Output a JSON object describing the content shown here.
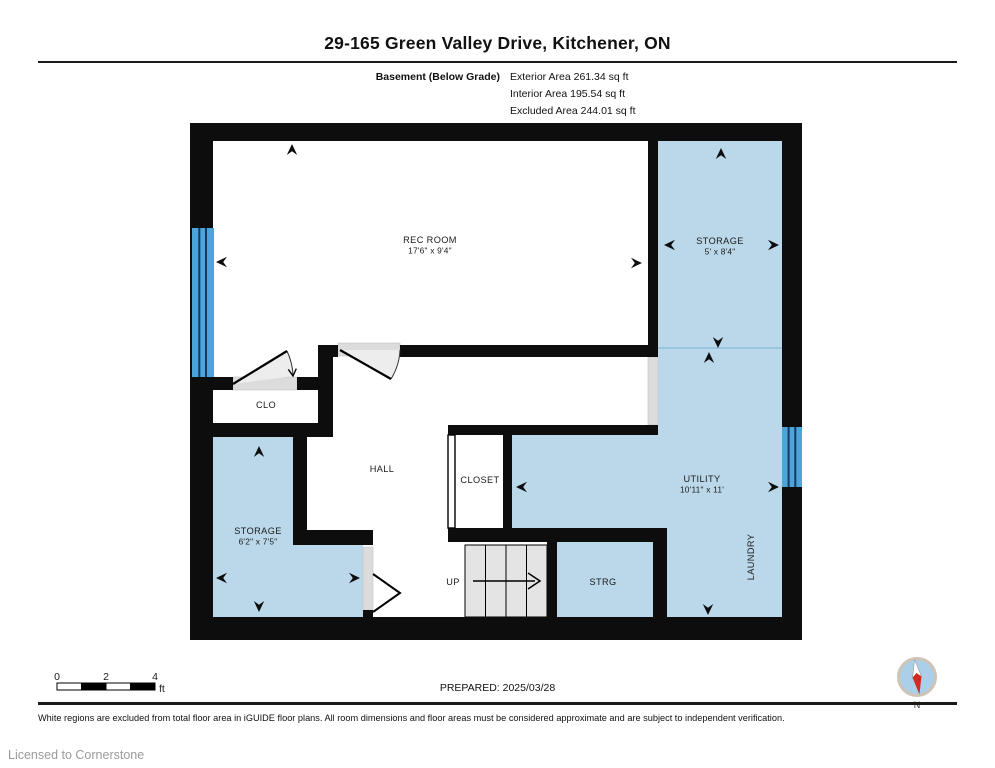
{
  "header": {
    "title": "29-165 Green Valley Drive, Kitchener, ON",
    "floor_label": "Basement (Below Grade)",
    "areas": [
      {
        "label": "Exterior Area 261.34 sq ft"
      },
      {
        "label": "Interior Area 195.54 sq ft"
      },
      {
        "label": "Excluded Area 244.01 sq ft"
      }
    ]
  },
  "plan": {
    "rooms": [
      {
        "name": "REC ROOM",
        "dims": "17'6\" x 9'4\""
      },
      {
        "name": "STORAGE",
        "dims": "5' x 8'4\""
      },
      {
        "name": "CLO",
        "dims": ""
      },
      {
        "name": "HALL",
        "dims": ""
      },
      {
        "name": "CLOSET",
        "dims": ""
      },
      {
        "name": "UTILITY",
        "dims": "10'11\" x 11'"
      },
      {
        "name": "LAUNDRY",
        "dims": ""
      },
      {
        "name": "STORAGE",
        "dims": "6'2\" x 7'5\""
      },
      {
        "name": "UP",
        "dims": ""
      },
      {
        "name": "STRG",
        "dims": ""
      }
    ],
    "colors": {
      "room_fill": "#bad8ea",
      "window_blue": "#4ba4da",
      "wall": "#0d0d0d",
      "stairs": "#e4e4e4",
      "door_sill": "#dcdcdc"
    }
  },
  "scale_bar": {
    "tick0": "0",
    "tick2": "2",
    "tick4": "4",
    "unit": "ft"
  },
  "compass": {
    "label": "N",
    "needle_color": "#cf2b20"
  },
  "footer": {
    "prepared": "PREPARED: 2025/03/28",
    "disclaimer": "White regions are excluded from total floor area in iGUIDE floor plans. All room dimensions and floor areas must be considered approximate and are subject to independent verification.",
    "licensed": "Licensed to Cornerstone"
  }
}
